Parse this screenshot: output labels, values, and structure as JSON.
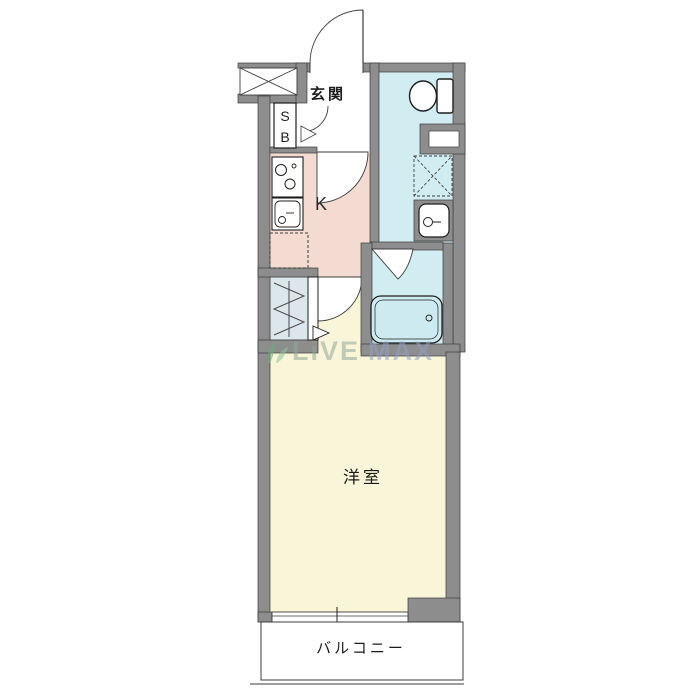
{
  "floor_plan": {
    "title": "1K apartment floor plan",
    "labels": {
      "entrance": "玄関",
      "shoe_box_line1": "S",
      "shoe_box_line2": "B",
      "kitchen": "K",
      "western_room": "洋室",
      "balcony": "バルコニー"
    },
    "watermark": {
      "part1": "LiVE",
      "part2": "MAX"
    },
    "rooms": [
      {
        "name": "entrance",
        "label": "玄関",
        "floor_color": "#ffffff"
      },
      {
        "name": "kitchen",
        "label": "K",
        "floor_color": "#f3dbd1"
      },
      {
        "name": "toilet-laundry-room",
        "label": "",
        "floor_color": "#d2edf2"
      },
      {
        "name": "bathroom",
        "label": "",
        "floor_color": "#d2edf2"
      },
      {
        "name": "closet",
        "label": "",
        "floor_color": "#dce7ed"
      },
      {
        "name": "western-room",
        "label": "洋室",
        "floor_color": "#f8f5d9"
      },
      {
        "name": "balcony",
        "label": "バルコニー",
        "floor_color": "#ffffff"
      }
    ],
    "fixtures": [
      "meter-box-x",
      "shoe-box",
      "entrance-door-arc",
      "interior-door-arcs",
      "stove",
      "kitchen-sink",
      "refrigerator-space-dashed",
      "toilet",
      "wall-niche",
      "washing-machine-space-dashed",
      "wash-basin",
      "bath-door-wedge",
      "bathtub",
      "closet-hanger-pipe",
      "closet-door",
      "sliding-window",
      "balcony-outline"
    ],
    "colors": {
      "wall": "#8d8d8d",
      "outline": "#3c3c3c",
      "kitchen_floor": "#f3dbd1",
      "wet_area_floor": "#d2edf2",
      "closet_floor": "#dce7ed",
      "western_room_floor": "#f8f5d9",
      "door_white": "#ffffff",
      "watermark_green": "#93a896",
      "watermark_blue": "#93a0c4",
      "logo_green": "#6fae7e"
    }
  }
}
